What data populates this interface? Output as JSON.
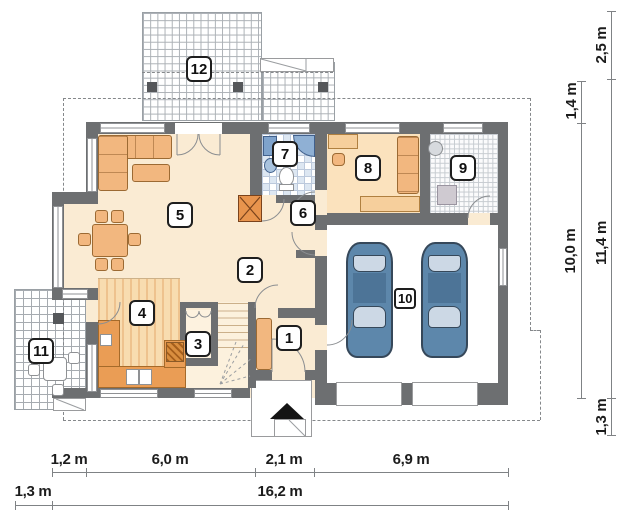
{
  "plan": {
    "room_labels": [
      "1",
      "2",
      "3",
      "4",
      "5",
      "6",
      "7",
      "8",
      "9",
      "10",
      "11",
      "12"
    ]
  },
  "dimensions": {
    "bottom_upper": [
      "1,2 m",
      "6,0 m",
      "2,1 m",
      "6,9 m"
    ],
    "bottom_lower": [
      "1,3 m",
      "16,2 m"
    ],
    "right_inner": [
      "1,4 m",
      "10,0 m"
    ],
    "right_outer": [
      "2,5 m",
      "11,4 m",
      "1,3 m"
    ]
  },
  "colors": {
    "wall": "#6d6f71",
    "floor_cream": "#faebd3",
    "floor_room8": "#fbe2bd",
    "wood_stripe": "#eec28e",
    "counter_orange": "#ea9d55",
    "furniture_orange": "#f2b77f",
    "fireplace_orange": "#e8944d",
    "car_blue": "#5d87ab",
    "bath_fixture_blue": "#8fb0d4",
    "garage_floor": "#ffffff"
  }
}
